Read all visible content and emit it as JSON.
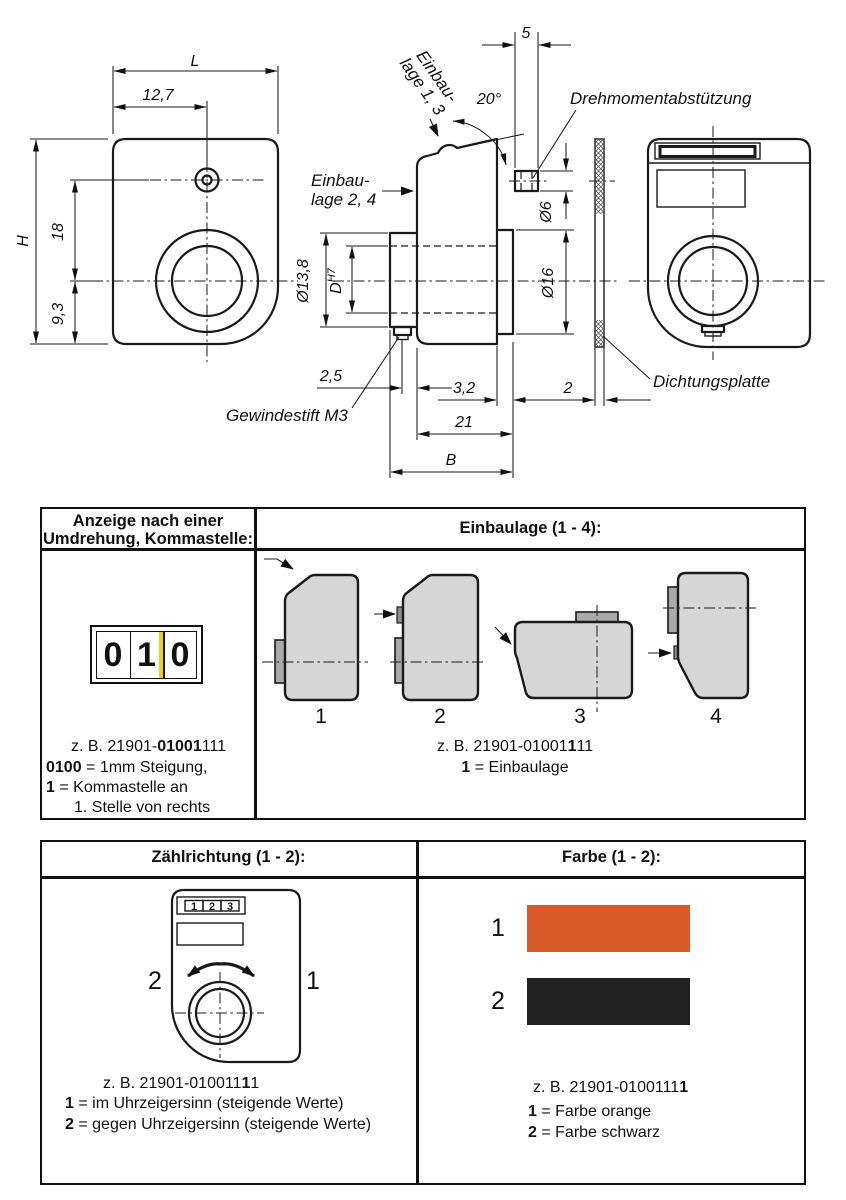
{
  "drawing": {
    "front": {
      "dim_L": "L",
      "dim_12_7": "12,7",
      "dim_H": "H",
      "dim_18": "18",
      "dim_9_3": "9,3"
    },
    "side": {
      "dim_5": "5",
      "dim_angle": "20°",
      "dim_d6": "Ø6",
      "dim_d16": "Ø16",
      "dim_d13_8": "Ø13,8",
      "dim_D": "D",
      "dim_D_tol": "H7",
      "dim_2_5": "2,5",
      "dim_3_2": "3,2",
      "dim_21": "21",
      "dim_B": "B",
      "einbaulage_1_3_line1": "Einbau-",
      "einbaulage_1_3_line2": "lage 1, 3",
      "einbaulage_2_4_line1": "Einbau-",
      "einbaulage_2_4_line2": "lage 2, 4",
      "drehmomentabstuetzung": "Drehmomentabstützung",
      "gewindestift": "Gewindestift M3"
    },
    "seal": {
      "dim_2": "2",
      "dichtungsplatte": "Dichtungsplatte"
    }
  },
  "anzeige_section": {
    "header_line1": "Anzeige nach einer",
    "header_line2": "Umdrehung, Kommastelle:",
    "counter_digits": [
      "0",
      "1",
      "0"
    ],
    "comma_marker_color": "#f2cf10",
    "example": {
      "prefix": "z. B. 21901-",
      "bold": "01001",
      "suffix": "111"
    },
    "legend": [
      {
        "bold": "0100",
        "text": " = 1mm Steigung,"
      },
      {
        "bold": "1",
        "text": " = Kommastelle an"
      },
      {
        "bold": "",
        "text": "1. Stelle von rechts"
      }
    ]
  },
  "einbaulage_section": {
    "header": "Einbaulage (1 - 4):",
    "positions": [
      "1",
      "2",
      "3",
      "4"
    ],
    "example": {
      "prefix": "z. B. 21901-01001",
      "bold": "1",
      "suffix": "11"
    },
    "legend": [
      {
        "bold": "1",
        "text": " = Einbaulage"
      }
    ]
  },
  "zaehlrichtung_section": {
    "header": "Zählrichtung (1 - 2):",
    "display_digits": [
      "1",
      "2",
      "3"
    ],
    "direction_left": "2",
    "direction_right": "1",
    "example": {
      "prefix": "z. B. 21901-010011",
      "bold": "1",
      "suffix": "1"
    },
    "legend": [
      {
        "bold": "1",
        "text": " = im Uhrzeigersinn (steigende Werte)"
      },
      {
        "bold": "2",
        "text": " = gegen Uhrzeigersinn (steigende Werte)"
      }
    ]
  },
  "farbe_section": {
    "header": "Farbe (1 - 2):",
    "swatches": [
      {
        "num": "1",
        "color": "#d95b2a"
      },
      {
        "num": "2",
        "color": "#212121"
      }
    ],
    "example": {
      "prefix": "z. B. 21901-0100111",
      "bold": "1",
      "suffix": ""
    },
    "legend": [
      {
        "bold": "1",
        "text": " = Farbe orange"
      },
      {
        "bold": "2",
        "text": " = Farbe schwarz"
      }
    ]
  }
}
